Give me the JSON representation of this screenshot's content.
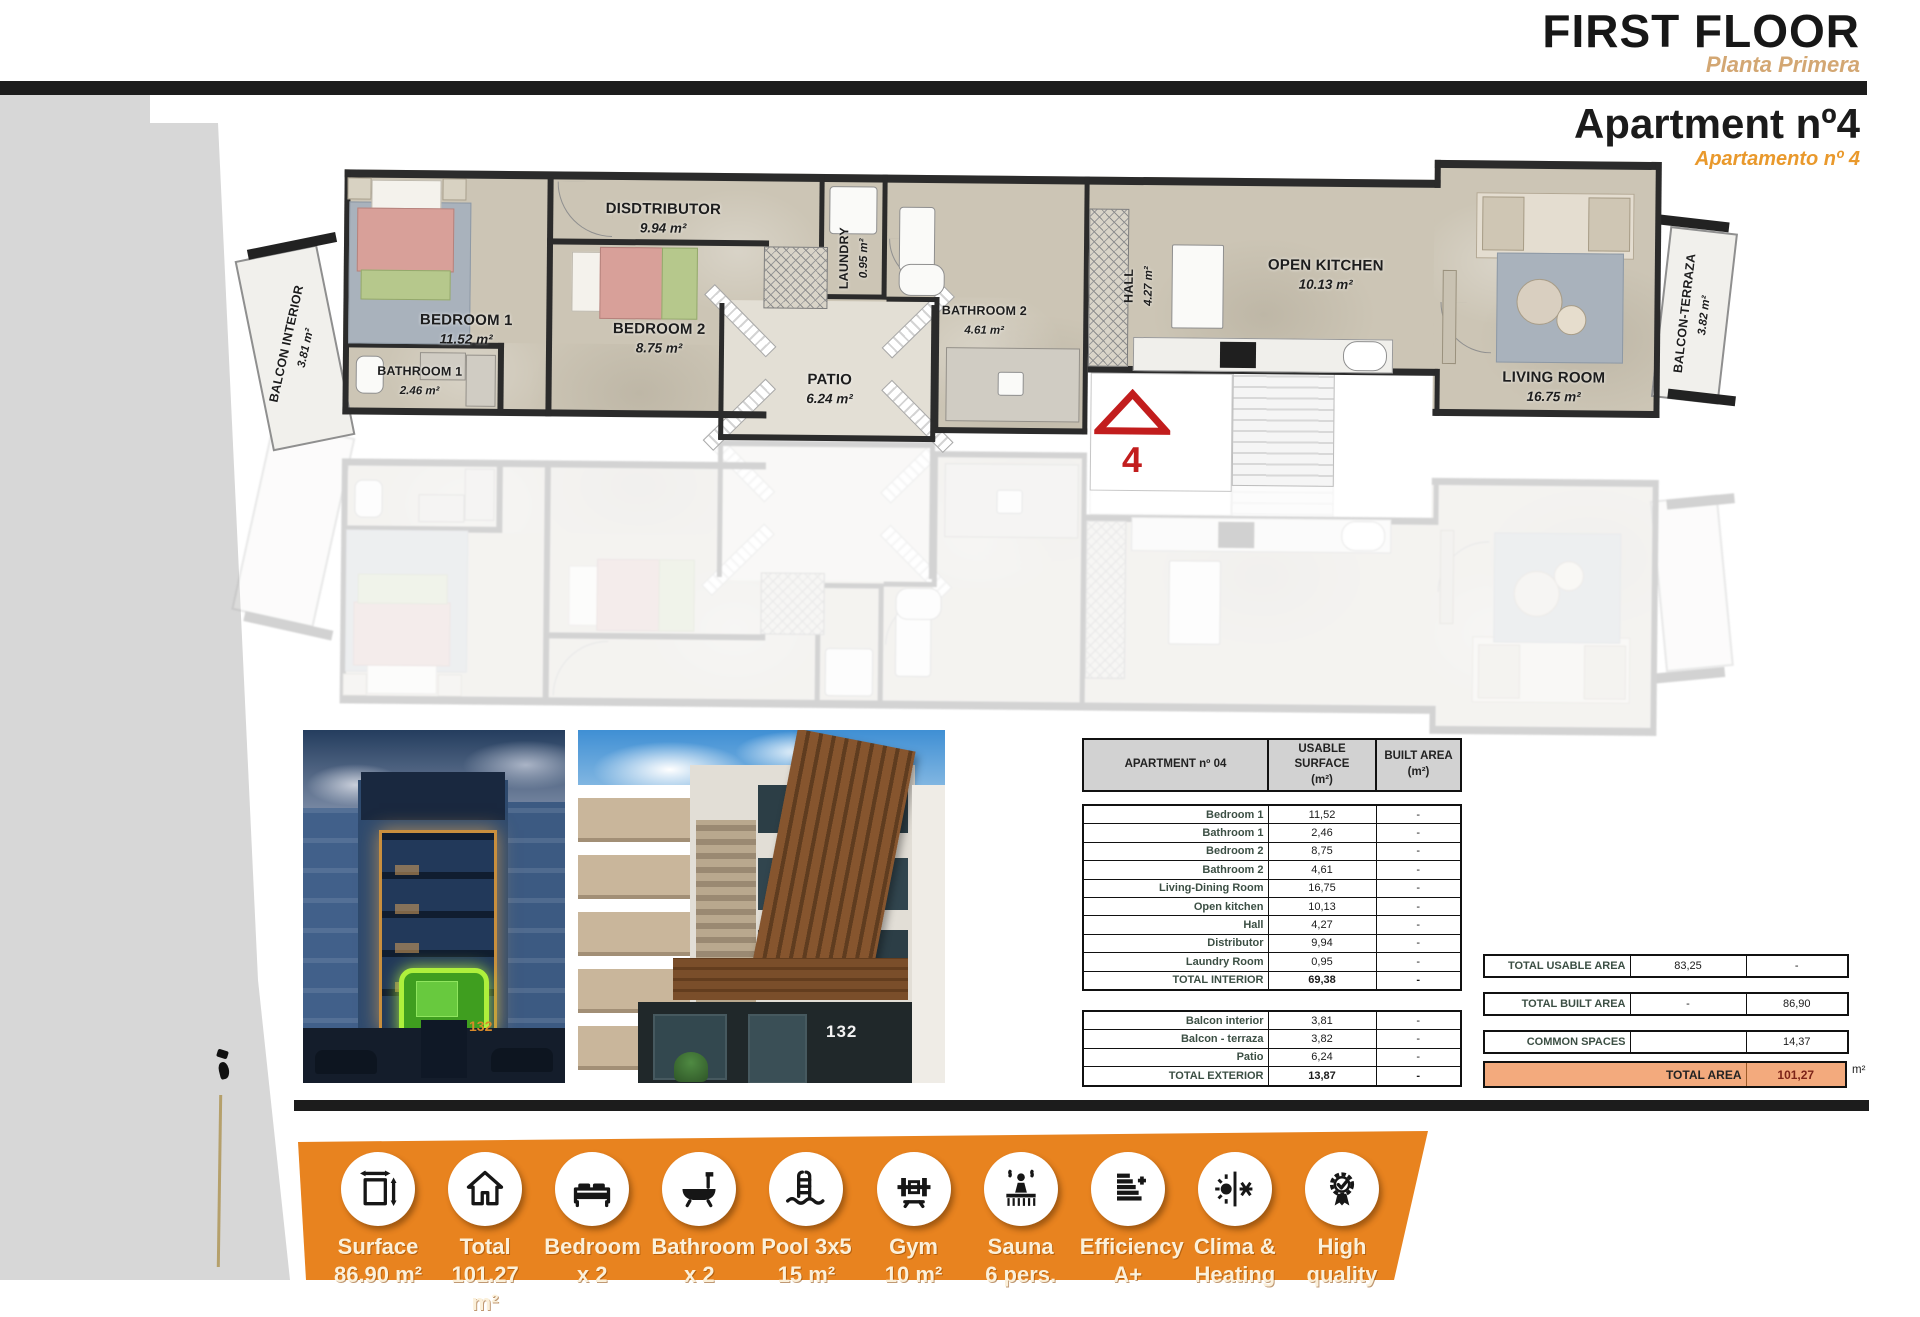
{
  "header": {
    "floor_title": "FIRST FLOOR",
    "floor_subtitle": "Planta Primera",
    "apartment_title": "Apartment nº4",
    "apartment_subtitle": "Apartamento nº 4"
  },
  "floorplan": {
    "unit_marker": "4",
    "rooms": [
      {
        "name": "BEDROOM 1",
        "area": "11.52 m²"
      },
      {
        "name": "BATHROOM 1",
        "area": "2.46 m²"
      },
      {
        "name": "DISDTRIBUTOR",
        "area": "9.94 m²"
      },
      {
        "name": "BEDROOM 2",
        "area": "8.75 m²"
      },
      {
        "name": "LAUNDRY",
        "area": "0.95 m²"
      },
      {
        "name": "PATIO",
        "area": "6.24 m²"
      },
      {
        "name": "BATHROOM 2",
        "area": "4.61 m²"
      },
      {
        "name": "HALL",
        "area": "4.27 m²"
      },
      {
        "name": "OPEN KITCHEN",
        "area": "10.13 m²"
      },
      {
        "name": "LIVING ROOM",
        "area": "16.75 m²"
      },
      {
        "name": "BALCON INTERIOR",
        "area": "3.81 m²"
      },
      {
        "name": "BALCON-TERRAZA",
        "area": "3.82 m²"
      }
    ]
  },
  "photos": {
    "left_house_number": "132",
    "right_house_number": "132"
  },
  "area_table": {
    "header": {
      "col1": "APARTMENT nº 04",
      "col2": "USABLE SURFACE",
      "col3": "BUILT AREA",
      "unit": "(m²)"
    },
    "interior": [
      {
        "label": "Bedroom 1",
        "usable": "11,52",
        "built": "-"
      },
      {
        "label": "Bathroom 1",
        "usable": "2,46",
        "built": "-"
      },
      {
        "label": "Bedroom 2",
        "usable": "8,75",
        "built": "-"
      },
      {
        "label": "Bathroom 2",
        "usable": "4,61",
        "built": "-"
      },
      {
        "label": "Living-Dining Room",
        "usable": "16,75",
        "built": "-"
      },
      {
        "label": "Open kitchen",
        "usable": "10,13",
        "built": "-"
      },
      {
        "label": "Hall",
        "usable": "4,27",
        "built": "-"
      },
      {
        "label": "Distributor",
        "usable": "9,94",
        "built": "-"
      },
      {
        "label": "Laundry Room",
        "usable": "0,95",
        "built": "-"
      },
      {
        "label": "TOTAL INTERIOR",
        "usable": "69,38",
        "built": "-"
      }
    ],
    "exterior": [
      {
        "label": "Balcon interior",
        "usable": "3,81",
        "built": "-"
      },
      {
        "label": "Balcon - terraza",
        "usable": "3,82",
        "built": "-"
      },
      {
        "label": "Patio",
        "usable": "6,24",
        "built": "-"
      },
      {
        "label": "TOTAL EXTERIOR",
        "usable": "13,87",
        "built": "-"
      }
    ]
  },
  "summary": {
    "rows": [
      {
        "label": "TOTAL USABLE AREA",
        "usable": "83,25",
        "built": "-"
      },
      {
        "label": "TOTAL BUILT AREA",
        "usable": "-",
        "built": "86,90"
      },
      {
        "label": "COMMON SPACES",
        "usable": "",
        "built": "14,37"
      }
    ],
    "total_row": {
      "label": "TOTAL AREA",
      "value": "101,27"
    },
    "unit": "m²"
  },
  "features": [
    {
      "icon": "surface-icon",
      "line1": "Surface",
      "line2": "86.90 m²"
    },
    {
      "icon": "total-icon",
      "line1": "Total",
      "line2": "101.27 m²"
    },
    {
      "icon": "bedroom-icon",
      "line1": "Bedroom",
      "line2": "x 2"
    },
    {
      "icon": "bathroom-icon",
      "line1": "Bathroom",
      "line2": "x 2"
    },
    {
      "icon": "pool-icon",
      "line1": "Pool 3x5",
      "line2": "15 m²"
    },
    {
      "icon": "gym-icon",
      "line1": "Gym",
      "line2": "10 m²"
    },
    {
      "icon": "sauna-icon",
      "line1": "Sauna",
      "line2": "6 pers."
    },
    {
      "icon": "efficiency-icon",
      "line1": "Efficiency",
      "line2": "A+"
    },
    {
      "icon": "clima-icon",
      "line1": "Clima &",
      "line2": "Heating"
    },
    {
      "icon": "quality-icon",
      "line1": "High",
      "line2": "quality"
    }
  ],
  "colors": {
    "accent_orange": "#e8831f",
    "total_row_bg": "#f3aa7d",
    "subtitle_tan": "#d3a773",
    "apartment_orange": "#e9992c",
    "marker_red": "#c21d1d",
    "highlight_green": "#9bf03c"
  }
}
